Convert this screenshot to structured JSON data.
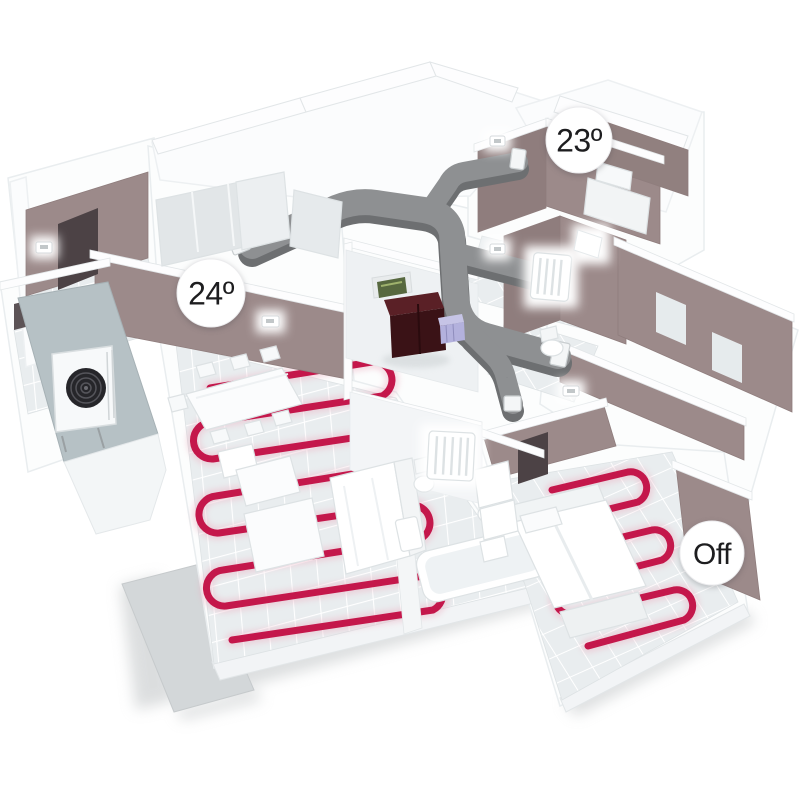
{
  "badges": {
    "living_room": {
      "label": "24º"
    },
    "bathroom_top": {
      "label": "23º"
    },
    "bedroom": {
      "label": "Off"
    }
  },
  "colors": {
    "background": "#ffffff",
    "heating_pipe": "#c4174b",
    "heating_pipe_glow": "#ecb3c4",
    "duct": "#8e9092",
    "duct_side": "#6d6f71",
    "wall_accent": "#9c8a8a",
    "wall_opening_dark": "#4c4245",
    "exterior_wall": "#b6c1c5",
    "tile": "#e9edef",
    "tile_grout": "#ffffff",
    "hvac_front": "#3a1216",
    "hvac_top": "#5a2026",
    "hvac_module": "#b3b1dd",
    "hvac_board": "#57683f",
    "fan_dark": "#26262a",
    "badge_background": "#ffffff",
    "badge_text": "#1d1d1f"
  }
}
